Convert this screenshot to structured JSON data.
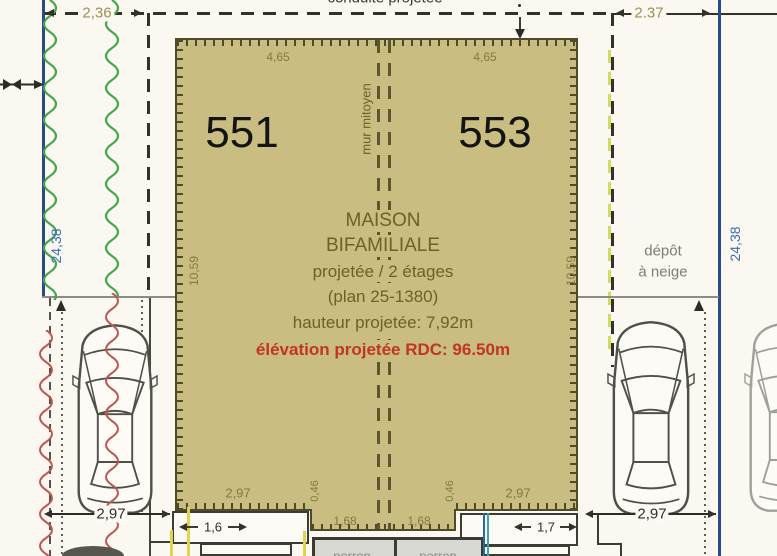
{
  "colors": {
    "paper": "#faf8f1",
    "building_fill": "#c9bd82",
    "building_edge": "#4f4a28",
    "dimension_olive": "#857a3e",
    "info_text_olive": "#6b6228",
    "elevation_red": "#c23423",
    "utility_blue": "#2c4a86",
    "length_text_blue": "#3a6cb4",
    "hedge_green": "#44a648",
    "hedge_red": "#c05552",
    "boundary_dark": "#32322a",
    "neutral_gray": "#7d7d77"
  },
  "top": {
    "clipped_label": "conduite projetée",
    "dim_left": "2,36",
    "dim_right": "2.37"
  },
  "parcels": {
    "left": "551",
    "right": "553"
  },
  "party_wall_label": "mur mitoyen",
  "building": {
    "dims": {
      "top_left": "4,65",
      "top_right": "4,65",
      "side_left": "10,59",
      "side_right": "10,59",
      "bottom_left": "2,97",
      "bottom_right": "2,97",
      "offset_left": "0,46",
      "offset_right": "0,46",
      "entry_left": "1,68",
      "entry_right": "1,68"
    },
    "info": {
      "title1": "MAISON",
      "title2": "BIFAMILIALE",
      "line3": "projetée / 2 étages",
      "line4": "(plan 25-1380)",
      "line5": "hauteur projetée: 7,92m",
      "elevation": "élévation projetée RDC: 96.50m"
    }
  },
  "sides": {
    "left_length": "24,38",
    "right_length": "24,38",
    "snow_line1": "dépôt",
    "snow_line2": "à neige"
  },
  "parking": {
    "left_width": "2,97",
    "right_width": "2,97"
  },
  "porches": {
    "left_dim": "1,6",
    "right_dim": "1,7",
    "left_step_label": "perron",
    "right_step_label": "perron"
  }
}
